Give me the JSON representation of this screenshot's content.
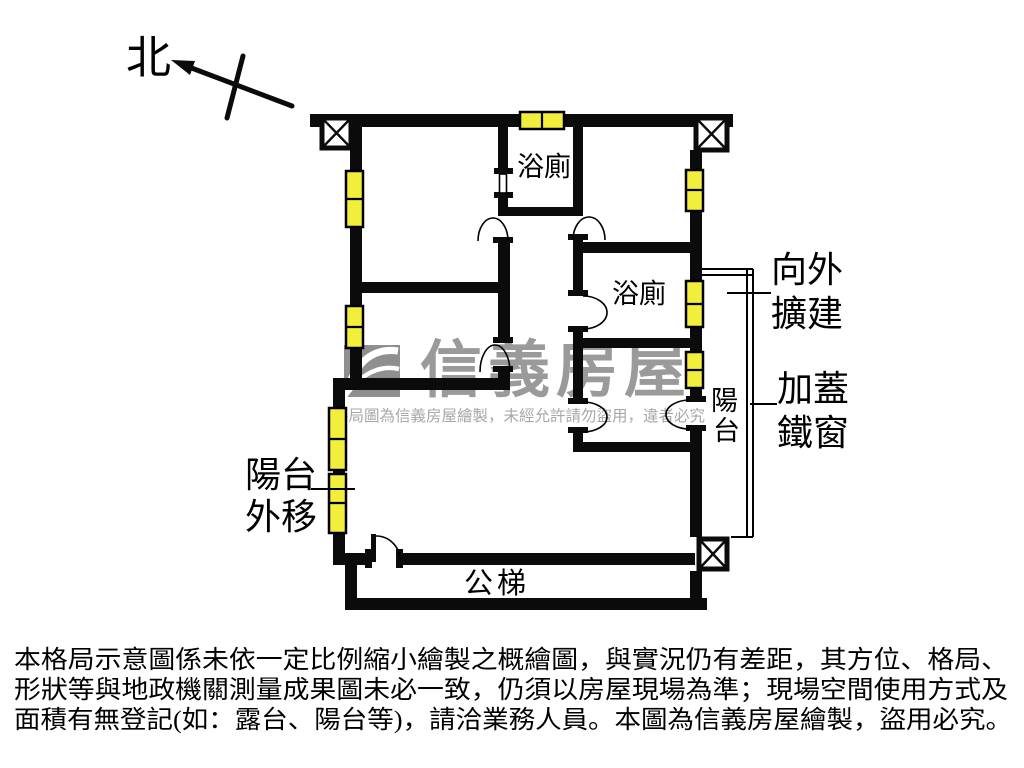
{
  "compass": {
    "north_label": "北"
  },
  "plan": {
    "rooms": {
      "bathroom_top_label": "浴廁",
      "bathroom_middle_label": "浴廁",
      "balcony_right_label": "陽台",
      "public_stairs_label": "公梯"
    },
    "annotations": {
      "expand_outward": [
        "向外",
        "擴建"
      ],
      "added_iron_window": [
        "加蓋",
        "鐵窗"
      ],
      "balcony_moved_out": [
        "陽台",
        "外移"
      ]
    }
  },
  "watermark": {
    "brand": "信義房屋",
    "notice": "格局圖為信義房屋繪製，未經允許請勿盜用，違者必究"
  },
  "disclaimer": {
    "lines": [
      "本格局示意圖係未依一定比例縮小繪製之概繪圖，與實況仍有差距，其方位、格局、",
      "形狀等與地政機關測量成果圖未必一致，仍須以房屋現場為準；現場空間使用方式及",
      "面積有無登記(如：露台、陽台等)，請洽業務人員。本圖為信義房屋繪製，盜用必究。"
    ]
  },
  "colors": {
    "wall": "#0b0b0b",
    "window_fill": "#f2ee3c",
    "watermark_brand": "#9a9a9a",
    "watermark_notice": "#a8a8a8",
    "disclaimer_text": "#000000",
    "background": "#ffffff"
  }
}
